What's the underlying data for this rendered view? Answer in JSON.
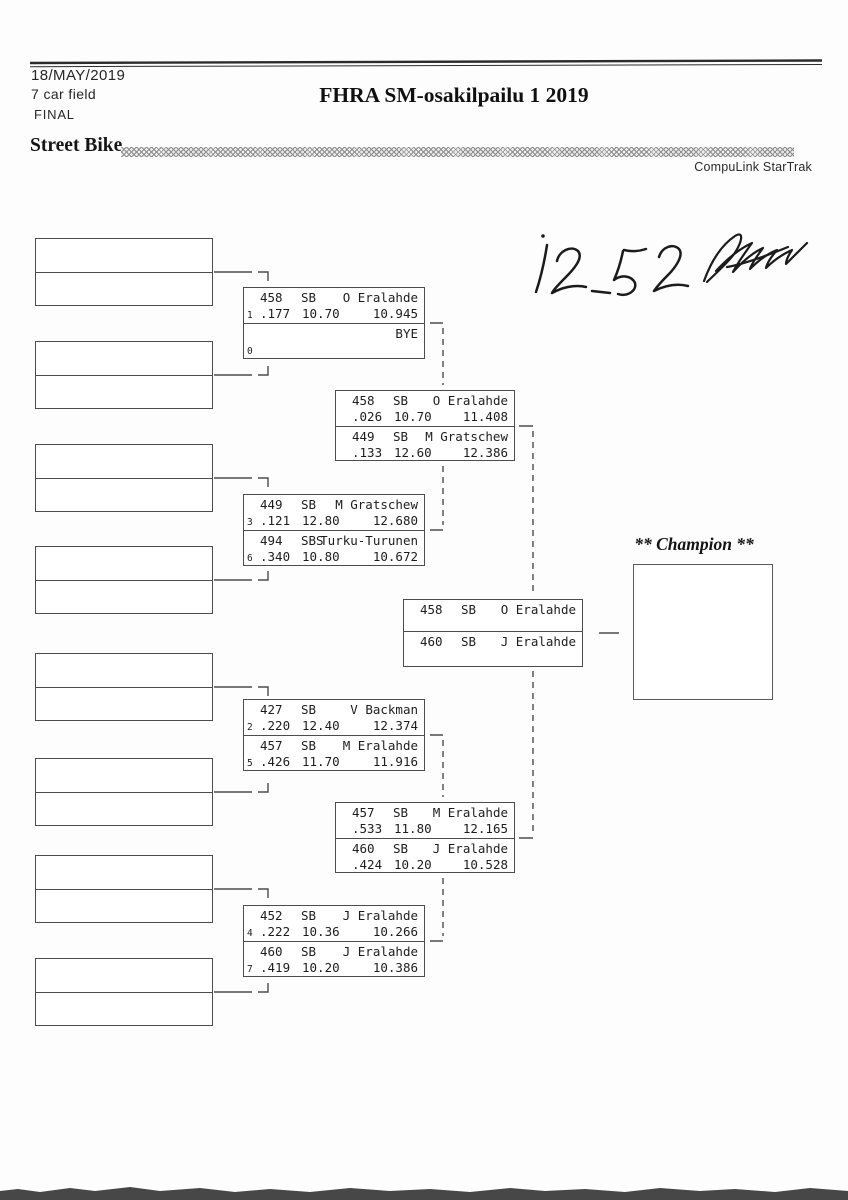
{
  "page": {
    "date": "18/MAY/2019",
    "field_size": "7 car field",
    "round_label": "FINAL",
    "title": "FHRA SM-osakilpailu 1 2019",
    "class_name": "Street Bike",
    "brand": "CompuLink StarTrak",
    "handwritten_note": "12_52",
    "champion_label": "** Champion **",
    "ink_color": "#1b1b1b",
    "line_color": "#4c4c4c"
  },
  "bracket": {
    "round1": [
      {
        "top": {
          "seed": "1",
          "num": "458",
          "cls": "SB",
          "driver": "O Eralahde",
          "rt": ".177",
          "et": "10.70",
          "res": "10.945"
        },
        "bot": {
          "seed": "0",
          "num": "",
          "cls": "",
          "driver": "BYE",
          "rt": "",
          "et": "",
          "res": ""
        }
      },
      {
        "top": {
          "seed": "3",
          "num": "449",
          "cls": "SB",
          "driver": "M Gratschew",
          "rt": ".121",
          "et": "12.80",
          "res": "12.680"
        },
        "bot": {
          "seed": "6",
          "num": "494",
          "cls": "SBS",
          "driver": "Turku-Turunen",
          "rt": ".340",
          "et": "10.80",
          "res": "10.672"
        }
      },
      {
        "top": {
          "seed": "2",
          "num": "427",
          "cls": "SB",
          "driver": "V Backman",
          "rt": ".220",
          "et": "12.40",
          "res": "12.374"
        },
        "bot": {
          "seed": "5",
          "num": "457",
          "cls": "SB",
          "driver": "M Eralahde",
          "rt": ".426",
          "et": "11.70",
          "res": "11.916"
        }
      },
      {
        "top": {
          "seed": "4",
          "num": "452",
          "cls": "SB",
          "driver": "J Eralahde",
          "rt": ".222",
          "et": "10.36",
          "res": "10.266"
        },
        "bot": {
          "seed": "7",
          "num": "460",
          "cls": "SB",
          "driver": "J Eralahde",
          "rt": ".419",
          "et": "10.20",
          "res": "10.386"
        }
      }
    ],
    "round2": [
      {
        "top": {
          "num": "458",
          "cls": "SB",
          "driver": "O Eralahde",
          "rt": ".026",
          "et": "10.70",
          "res": "11.408"
        },
        "bot": {
          "num": "449",
          "cls": "SB",
          "driver": "M Gratschew",
          "rt": ".133",
          "et": "12.60",
          "res": "12.386"
        }
      },
      {
        "top": {
          "num": "457",
          "cls": "SB",
          "driver": "M Eralahde",
          "rt": ".533",
          "et": "11.80",
          "res": "12.165"
        },
        "bot": {
          "num": "460",
          "cls": "SB",
          "driver": "J Eralahde",
          "rt": ".424",
          "et": "10.20",
          "res": "10.528"
        }
      }
    ],
    "final": {
      "top": {
        "num": "458",
        "cls": "SB",
        "driver": "O Eralahde"
      },
      "bot": {
        "num": "460",
        "cls": "SB",
        "driver": "J Eralahde"
      }
    }
  }
}
